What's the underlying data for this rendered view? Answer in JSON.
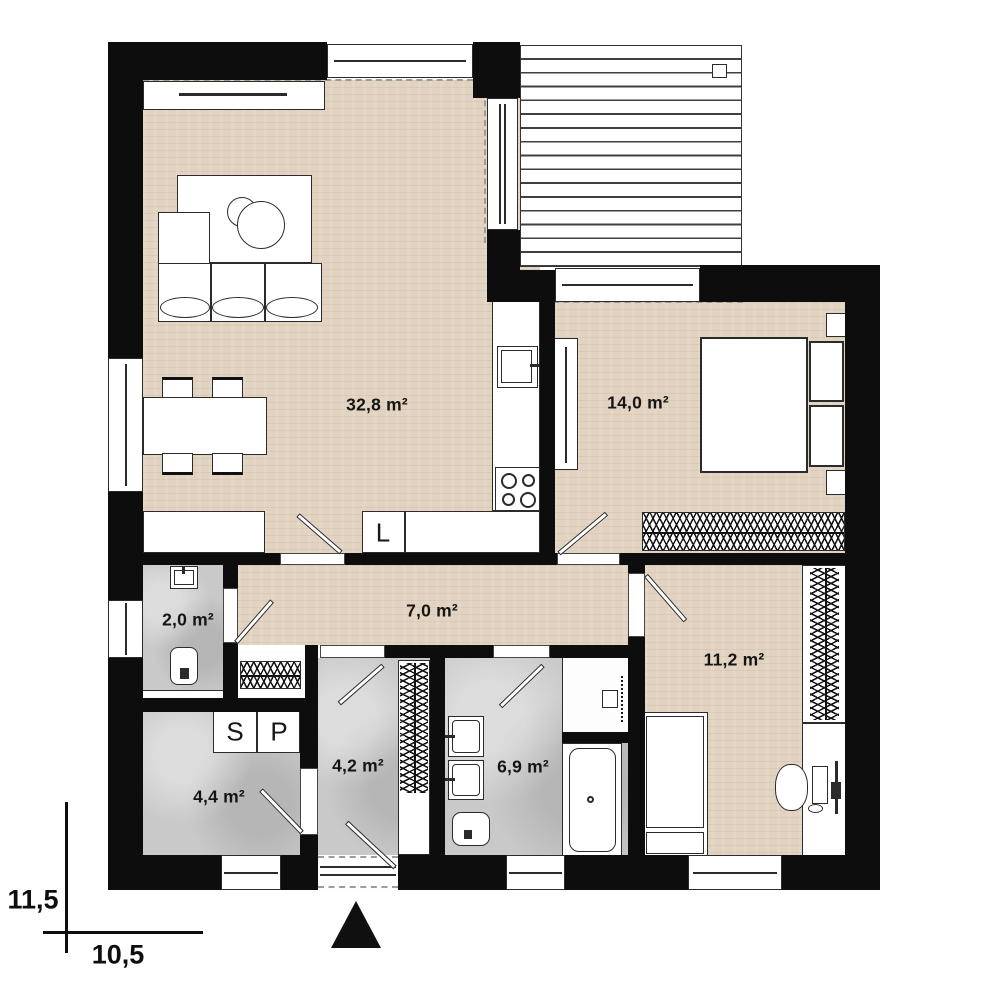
{
  "rooms": {
    "living": {
      "label": "32,8 m²"
    },
    "bedroom": {
      "label": "14,0 m²"
    },
    "hall": {
      "label": "7,0 m²"
    },
    "wc": {
      "label": "2,0 m²"
    },
    "kids_room": {
      "label": "11,2 m²"
    },
    "entry": {
      "label": "4,2 m²"
    },
    "utility": {
      "label": "4,4 m²"
    },
    "bathroom": {
      "label": "6,9 m²"
    }
  },
  "appliances": {
    "fridge_label": "L",
    "dryer_label": "S",
    "washer_label": "P"
  },
  "dimensions": {
    "vertical": "11,5",
    "horizontal": "10,5"
  },
  "colors": {
    "wall": "#0d0d0d",
    "wood_floor": "#e2d3c1",
    "tile_floor": "#c9c9c9",
    "outline": "#2b2b2b",
    "roof_dash": "#9b9b9b"
  }
}
